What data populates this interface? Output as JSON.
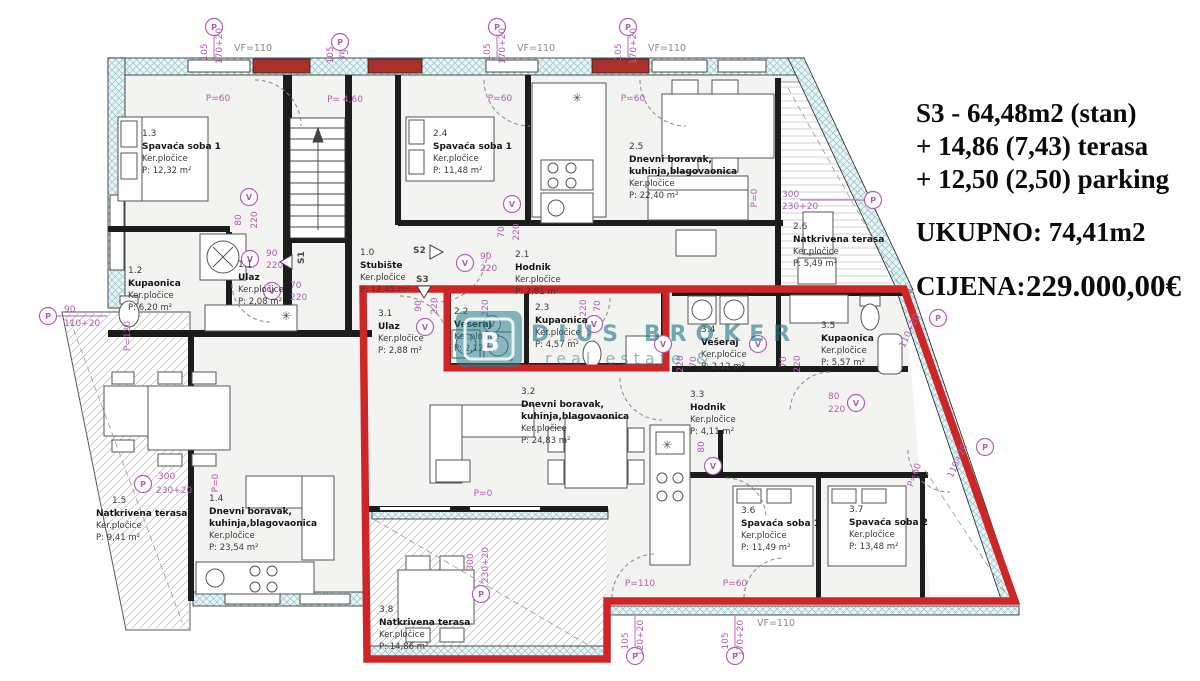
{
  "panel": {
    "line1": "S3 - 64,48m2 (stan)",
    "line2": "+ 14,86 (7,43) terasa",
    "line3": "+ 12,50 (2,50) parking",
    "total": "UKUPNO: 74,41m2",
    "price_label": "CIJENA:",
    "price": "229.000,00€"
  },
  "watermark": {
    "line1": "DIUS BROKER",
    "line2": "real estate &",
    "logo": "B"
  },
  "rooms": {
    "r10": {
      "id": "1.0",
      "name": "Stubište",
      "floor": "Ker.pločice",
      "area": "P: 12,45 m²"
    },
    "r11": {
      "id": "1.1",
      "name": "Ulaz",
      "floor": "Ker.pločice",
      "area": "P: 2,08 m²"
    },
    "r12": {
      "id": "1.2",
      "name": "Kupaonica",
      "floor": "Ker.pločice",
      "area": "P: 6,20 m²"
    },
    "r13": {
      "id": "1.3",
      "name": "Spavaća soba 1",
      "floor": "Ker.pločice",
      "area": "P: 12,32 m²"
    },
    "r14": {
      "id": "1.4",
      "name": "Dnevni boravak,",
      "name2": "kuhinja,blagovaonica",
      "floor": "Ker.pločice",
      "area": "P: 23,54 m²"
    },
    "r15": {
      "id": "1.5",
      "name": "Natkrivena terasa",
      "floor": "Ker.pločice",
      "area": "P: 9,41 m²"
    },
    "r21": {
      "id": "2.1",
      "name": "Hodnik",
      "floor": "Ker.pločice",
      "area": "P: 2,81 m²"
    },
    "r22": {
      "id": "2.2",
      "name": "Vešeraj",
      "floor": "Ker.pločice",
      "area": "P: 2,12 m²"
    },
    "r23": {
      "id": "2.3",
      "name": "Kupaonica",
      "floor": "Ker.pločice",
      "area": "P: 4,57 m²"
    },
    "r24": {
      "id": "2.4",
      "name": "Spavaća soba 1",
      "floor": "Ker.pločice",
      "area": "P: 11,48 m²"
    },
    "r25": {
      "id": "2.5",
      "name": "Dnevni boravak,",
      "name2": "kuhinja,blagovaonica",
      "floor": "Ker.pločice",
      "area": "P: 22,40 m²"
    },
    "r26": {
      "id": "2.6",
      "name": "Natkrivena terasa",
      "floor": "Ker.pločice",
      "area": "P: 5,49 m²"
    },
    "r31": {
      "id": "3.1",
      "name": "Ulaz",
      "floor": "Ker.pločice",
      "area": "P: 2,88 m²"
    },
    "r32": {
      "id": "3.2",
      "name": "Dnevni boravak,",
      "name2": "kuhinja,blagovaonica",
      "floor": "Ker.pločice",
      "area": "P: 24,83 m²"
    },
    "r33": {
      "id": "3.3",
      "name": "Hodnik",
      "floor": "Ker.pločice",
      "area": "P: 4,11 m²"
    },
    "r34": {
      "id": "3.4",
      "name": "Vešeraj",
      "floor": "Ker.pločice",
      "area": "P: 2,12 m²"
    },
    "r35": {
      "id": "3.5",
      "name": "Kupaonica",
      "floor": "Ker.pločice",
      "area": "P: 5,57 m²"
    },
    "r36": {
      "id": "3.6",
      "name": "Spavaća soba 1",
      "floor": "Ker.pločice",
      "area": "P: 11,49 m²"
    },
    "r37": {
      "id": "3.7",
      "name": "Spavaća soba 2",
      "floor": "Ker.pločice",
      "area": "P: 13,48 m²"
    },
    "r38": {
      "id": "3.8",
      "name": "Natkrivena terasa",
      "floor": "Ker.pločice",
      "area": "P: 14,86 m²"
    }
  },
  "dims": {
    "vf": "VF=110",
    "n105": "105",
    "n75": "75",
    "n170": "170+20",
    "n120": "120+20",
    "n110": "110+20",
    "n90": "90",
    "n80": "80",
    "n70": "70",
    "n220": "220",
    "n300": "300",
    "n230": "230+20",
    "p60": "P=60",
    "p110": "P=110",
    "p0": "P=0",
    "p120": "P=120",
    "p460": "P= 4,60",
    "s1": "S1",
    "s2": "S2",
    "s3": "S3",
    "pm": "P",
    "vm": "V",
    "star": "✳"
  },
  "colors": {
    "highlight": "#ce2626",
    "wall_hatch": "#8fc3cb",
    "dim": "#b15fb1",
    "watermark": "#21788a"
  }
}
